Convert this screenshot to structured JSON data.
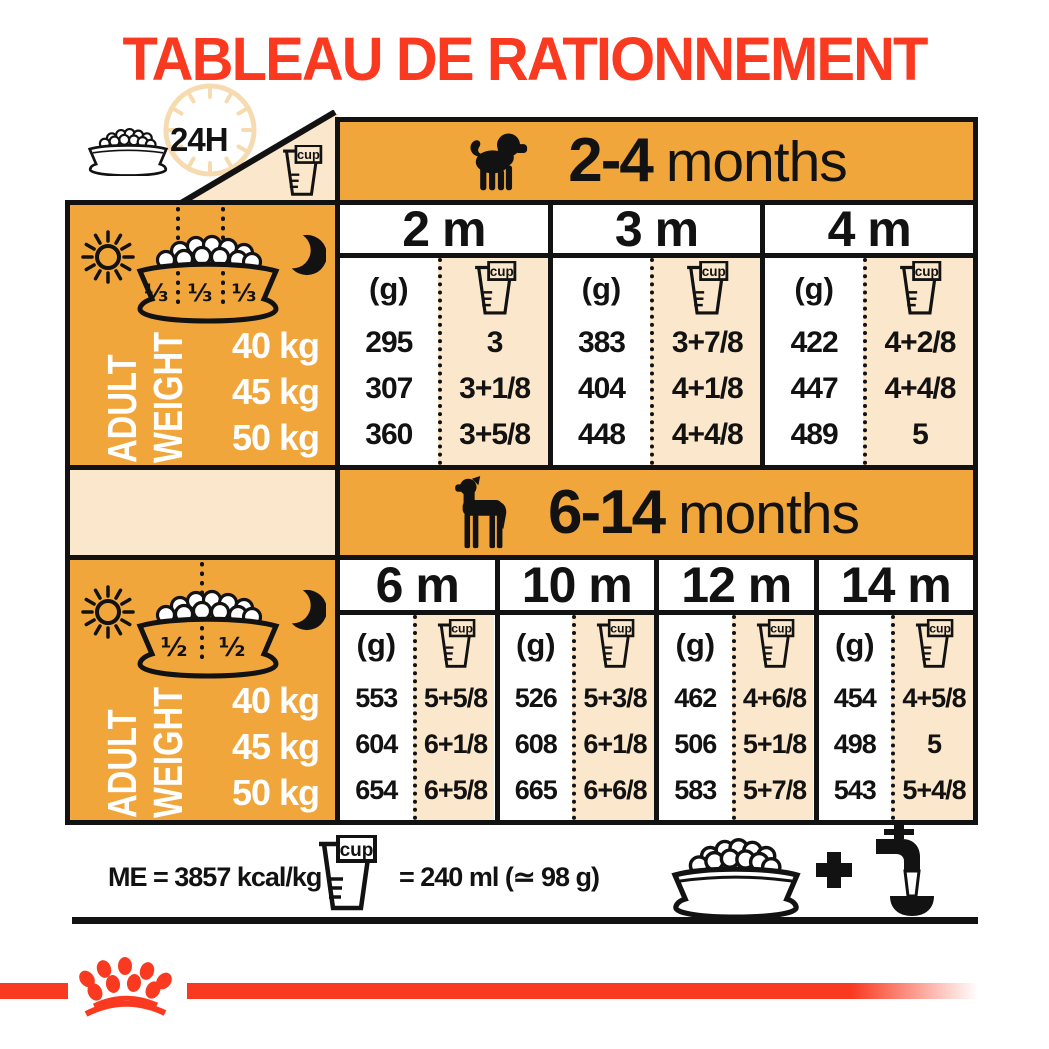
{
  "title": "TABLEAU DE RATIONNEMENT",
  "header": {
    "daily_label": "24H"
  },
  "units": {
    "grams_label": "(g)",
    "cup_label": "cup"
  },
  "left_panel_label": {
    "line1": "ADULT",
    "line2": "WEIGHT"
  },
  "weights": [
    "40 kg",
    "45 kg",
    "50 kg"
  ],
  "section1": {
    "age_bold": "2-4",
    "age_rest": "months",
    "portions": [
      "⅓",
      "⅓",
      "⅓"
    ],
    "months": [
      {
        "label": "2 m",
        "grams": [
          "295",
          "307",
          "360"
        ],
        "cups": [
          "3",
          "3+1/8",
          "3+5/8"
        ]
      },
      {
        "label": "3 m",
        "grams": [
          "383",
          "404",
          "448"
        ],
        "cups": [
          "3+7/8",
          "4+1/8",
          "4+4/8"
        ]
      },
      {
        "label": "4 m",
        "grams": [
          "422",
          "447",
          "489"
        ],
        "cups": [
          "4+2/8",
          "4+4/8",
          "5"
        ]
      }
    ]
  },
  "section2": {
    "age_bold": "6-14",
    "age_rest": "months",
    "portions": [
      "½",
      "½"
    ],
    "months": [
      {
        "label": "6 m",
        "grams": [
          "553",
          "604",
          "654"
        ],
        "cups": [
          "5+5/8",
          "6+1/8",
          "6+5/8"
        ]
      },
      {
        "label": "10 m",
        "grams": [
          "526",
          "608",
          "665"
        ],
        "cups": [
          "5+3/8",
          "6+1/8",
          "6+6/8"
        ]
      },
      {
        "label": "12 m",
        "grams": [
          "462",
          "506",
          "583"
        ],
        "cups": [
          "4+6/8",
          "5+1/8",
          "5+7/8"
        ]
      },
      {
        "label": "14 m",
        "grams": [
          "454",
          "498",
          "543"
        ],
        "cups": [
          "4+5/8",
          "5",
          "5+4/8"
        ]
      }
    ]
  },
  "footer": {
    "energy": "ME = 3857 kcal/kg",
    "cup_equivalence": "= 240 ml (≃ 98 g)"
  },
  "colors": {
    "orange": "#F1A63C",
    "cream": "#FBE7CB",
    "red": "#F93A20",
    "black": "#121212"
  }
}
